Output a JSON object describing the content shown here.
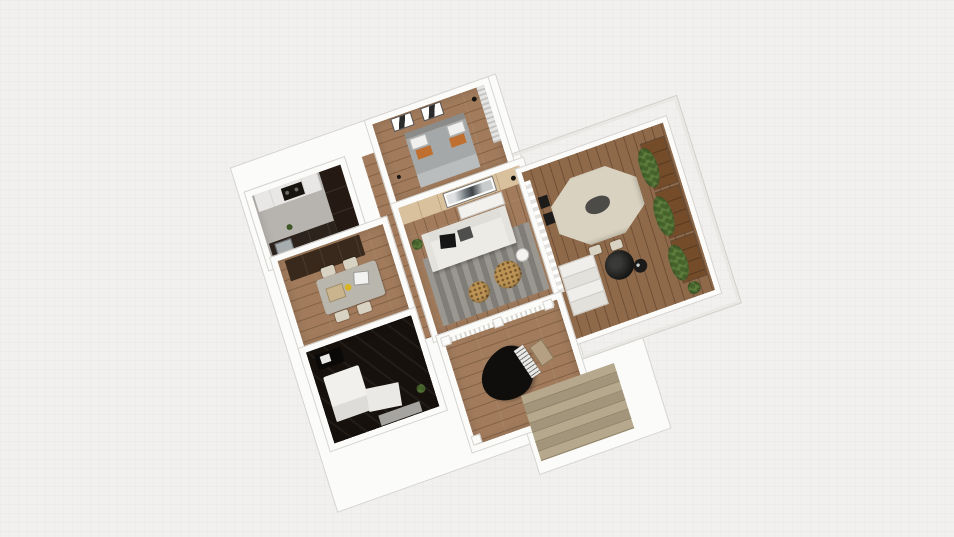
{
  "scene": {
    "type": "3d-floorplan-render",
    "view": "axonometric-top-down",
    "rooms": [
      {
        "name": "kitchen",
        "features": [
          "white countertop",
          "dark cooktop",
          "tall dark cabinet",
          "lower dark cabinets",
          "sink"
        ]
      },
      {
        "name": "dining-room",
        "features": [
          "dark sideboard",
          "gray dining table",
          "4 beige chairs",
          "tray",
          "yellow bowl",
          "white laptop"
        ]
      },
      {
        "name": "dark-bedroom",
        "features": [
          "black marble floor",
          "desk with laptop",
          "white bed",
          "gray bench",
          "small plant"
        ]
      },
      {
        "name": "master-bedroom",
        "features": [
          "double bed gray bedding",
          "2 orange pillows",
          "2 white pillows",
          "2 wall pictures",
          "floor lamp",
          "vertical blinds"
        ]
      },
      {
        "name": "living-room",
        "features": [
          "wood accent wall",
          "landscape art",
          "white media console",
          "white sofa",
          "black pillow",
          "gray pillow",
          "striped gray rug",
          "2 leopard poufs",
          "white side table",
          "potted plant",
          "floor lamp"
        ]
      },
      {
        "name": "balcony-terrace",
        "features": [
          "octagonal beige table",
          "dark centerpiece",
          "2 dark chairs",
          "2 beige chairs",
          "3 wood planter boxes with greenery",
          "corner potted plant",
          "black papasan chair",
          "black side table",
          "white steps",
          "white curtains",
          "glass pergola frame"
        ]
      },
      {
        "name": "piano-room",
        "features": [
          "black grand piano",
          "piano keys",
          "piano bench",
          "white columns",
          "balustrade"
        ]
      },
      {
        "name": "staircase",
        "features": [
          "7 beige treads descending"
        ]
      }
    ]
  },
  "colors": {
    "bg": "#f1f0ee",
    "wall": "#fbfbf9",
    "wall_edge": "#d6d4d0",
    "wood": "#a17b5c",
    "accent_wood": "#d9c19e",
    "kitchen_floor": "#b7b3af",
    "counter": "#e8e7e5",
    "cooktop": "#17140f",
    "cab_dark": "#241a13",
    "cab_brown": "#38291c",
    "table_gray": "#b9b6ae",
    "chair_beige": "#d8d2c2",
    "accent_yellow": "#d8b32a",
    "dark_floor": "#17110d",
    "bed": "#a4a8a9",
    "bed_head": "#8b8b89",
    "pillow_orange": "#bf7030",
    "sofa": "#edebe5",
    "rug": "#8e8b85",
    "pouf": "#bb9355",
    "deck": "#8e694a",
    "planter": "#744c2a",
    "plant": "#5d7d3d",
    "plant_dark": "#47632c",
    "table_beige": "#d9d2c0",
    "stairs": "#b5a88c",
    "stairs_dark": "#a2957b",
    "piano": "#0f0e0d",
    "black": "#151413"
  }
}
